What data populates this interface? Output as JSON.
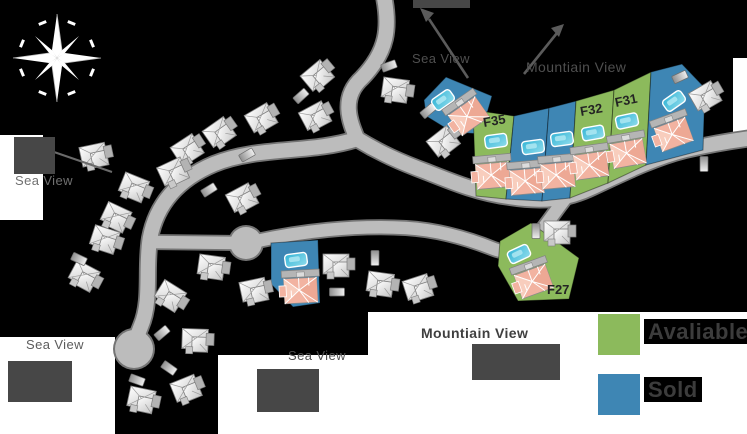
{
  "scene": {
    "width": 747,
    "height": 434,
    "background": "#000000"
  },
  "labels": {
    "sea_view_top": "Sea View",
    "mountain_view_top": "Mountiain View",
    "sea_view_left": "Sea View",
    "sea_view_bottom_left": "Sea View",
    "sea_view_bottom_middle": "Sea View",
    "mountain_view_bottom": "Mountiain View"
  },
  "legend": {
    "available_label": "Avaliable",
    "sold_label": "Sold",
    "available_color": "#8cba5c",
    "sold_color": "#3e86b4"
  },
  "map": {
    "road_color": "#bcbcbc",
    "road_edge_color": "#747474",
    "pool_color": "#49c0dc",
    "roof_color": "#f2b3a1",
    "plots": [
      {
        "label": "",
        "status": "sold",
        "points": [
          [
            424,
            100
          ],
          [
            446,
            77
          ],
          [
            492,
            96
          ],
          [
            481,
            134
          ],
          [
            452,
            132
          ],
          [
            426,
            116
          ]
        ],
        "pool": {
          "x": 443,
          "y": 100,
          "r": -35
        },
        "house": {
          "x": 467,
          "y": 113,
          "r": -35
        }
      },
      {
        "label": "F35",
        "status": "available",
        "points": [
          [
            473,
            110
          ],
          [
            514,
            116
          ],
          [
            506,
            199
          ],
          [
            476,
            196
          ]
        ],
        "pool": {
          "x": 496,
          "y": 141,
          "r": -8
        },
        "house": {
          "x": 493,
          "y": 172,
          "r": -5
        },
        "label_pos": {
          "x": 484,
          "y": 127,
          "r": -10
        }
      },
      {
        "label": "",
        "status": "sold",
        "points": [
          [
            514,
            116
          ],
          [
            549,
            108
          ],
          [
            542,
            201
          ],
          [
            506,
            199
          ]
        ],
        "pool": {
          "x": 533,
          "y": 147,
          "r": -8
        },
        "house": {
          "x": 527,
          "y": 178,
          "r": -5
        }
      },
      {
        "label": "",
        "status": "sold",
        "points": [
          [
            549,
            108
          ],
          [
            576,
            101
          ],
          [
            570,
            198
          ],
          [
            542,
            201
          ]
        ],
        "pool": {
          "x": 562,
          "y": 139,
          "r": -8
        },
        "house": {
          "x": 558,
          "y": 172,
          "r": -5
        }
      },
      {
        "label": "F32",
        "status": "available",
        "points": [
          [
            576,
            101
          ],
          [
            614,
            90
          ],
          [
            608,
            183
          ],
          [
            570,
            198
          ]
        ],
        "pool": {
          "x": 593,
          "y": 133,
          "r": -10
        },
        "house": {
          "x": 591,
          "y": 162,
          "r": -8
        },
        "label_pos": {
          "x": 581,
          "y": 116,
          "r": -10
        }
      },
      {
        "label": "F31",
        "status": "available",
        "points": [
          [
            614,
            90
          ],
          [
            651,
            72
          ],
          [
            646,
            165
          ],
          [
            608,
            183
          ]
        ],
        "pool": {
          "x": 627,
          "y": 121,
          "r": -12
        },
        "house": {
          "x": 628,
          "y": 150,
          "r": -10
        },
        "label_pos": {
          "x": 616,
          "y": 107,
          "r": -12
        }
      },
      {
        "label": "",
        "status": "sold",
        "points": [
          [
            651,
            72
          ],
          [
            682,
            64
          ],
          [
            705,
            88
          ],
          [
            703,
            150
          ],
          [
            646,
            165
          ]
        ],
        "pool": {
          "x": 674,
          "y": 101,
          "r": -35
        },
        "house": {
          "x": 673,
          "y": 131,
          "r": -20
        }
      },
      {
        "label": "F27",
        "status": "available",
        "points": [
          [
            500,
            241
          ],
          [
            531,
            223
          ],
          [
            579,
            258
          ],
          [
            569,
            299
          ],
          [
            518,
            301
          ],
          [
            498,
            266
          ]
        ],
        "pool": {
          "x": 519,
          "y": 254,
          "r": -25
        },
        "house": {
          "x": 533,
          "y": 278,
          "r": -20
        },
        "label_pos": {
          "x": 547,
          "y": 294,
          "r": 0
        }
      },
      {
        "label": "",
        "status": "sold",
        "points": [
          [
            271,
            243
          ],
          [
            318,
            240
          ],
          [
            320,
            303
          ],
          [
            293,
            307
          ],
          [
            271,
            284
          ]
        ],
        "pool": {
          "x": 296,
          "y": 260,
          "r": -8
        },
        "house": {
          "x": 301,
          "y": 287,
          "r": -3
        }
      }
    ],
    "houses": [
      [
        320,
        75,
        -40
      ],
      [
        318,
        116,
        -28
      ],
      [
        264,
        118,
        -30
      ],
      [
        222,
        132,
        -35
      ],
      [
        190,
        149,
        -33
      ],
      [
        176,
        172,
        -25
      ],
      [
        136,
        189,
        22
      ],
      [
        97,
        156,
        -12
      ],
      [
        118,
        219,
        25
      ],
      [
        107,
        241,
        18
      ],
      [
        86,
        278,
        28
      ],
      [
        172,
        298,
        32
      ],
      [
        214,
        268,
        8
      ],
      [
        257,
        291,
        -12
      ],
      [
        198,
        341,
        2
      ],
      [
        189,
        389,
        -22
      ],
      [
        144,
        401,
        12
      ],
      [
        398,
        91,
        8
      ],
      [
        446,
        141,
        -38
      ],
      [
        339,
        266,
        0
      ],
      [
        383,
        285,
        8
      ],
      [
        421,
        288,
        -18
      ],
      [
        560,
        233,
        0
      ],
      [
        708,
        96,
        -30
      ],
      [
        245,
        198,
        -28
      ]
    ],
    "cars": [
      [
        301,
        96,
        -42
      ],
      [
        428,
        111,
        -40
      ],
      [
        389,
        66,
        -20
      ],
      [
        375,
        258,
        90
      ],
      [
        337,
        292,
        0
      ],
      [
        536,
        231,
        90
      ],
      [
        704,
        164,
        90
      ],
      [
        680,
        77,
        -25
      ],
      [
        162,
        333,
        -40
      ],
      [
        169,
        368,
        35
      ],
      [
        137,
        380,
        20
      ],
      [
        209,
        190,
        -32
      ],
      [
        79,
        259,
        25
      ],
      [
        247,
        155,
        -30
      ]
    ]
  }
}
